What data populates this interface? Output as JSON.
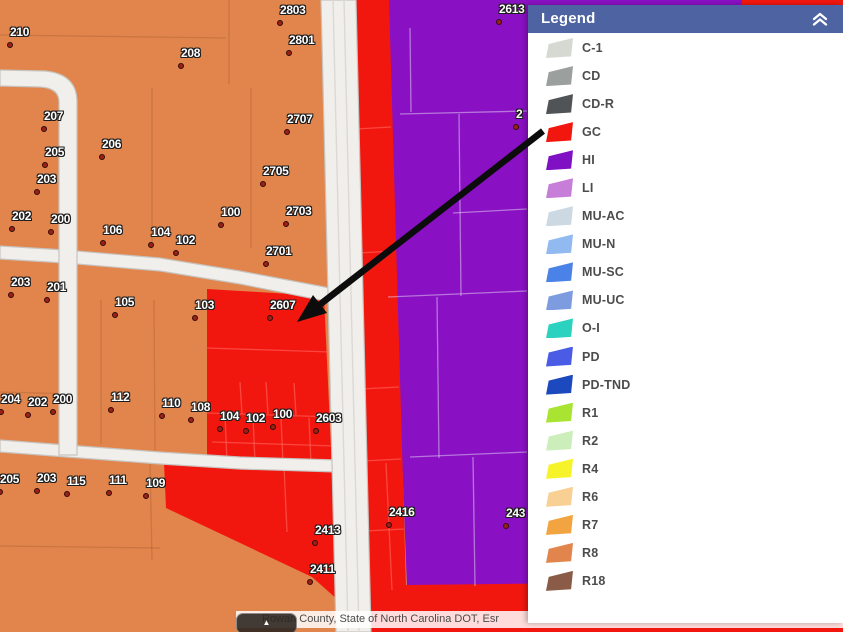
{
  "colors": {
    "R8_map": "#e1854d",
    "GC_map": "#f2170e",
    "HI_map": "#8a10c4",
    "header_bg": "#4e64a2",
    "arrow": "#0c0c0c"
  },
  "legend": {
    "title": "Legend",
    "items": [
      {
        "label": "C-1",
        "color": "#d6d9d2"
      },
      {
        "label": "CD",
        "color": "#9b9f9e"
      },
      {
        "label": "CD-R",
        "color": "#505456"
      },
      {
        "label": "GC",
        "color": "#f2170e"
      },
      {
        "label": "HI",
        "color": "#7f10c3"
      },
      {
        "label": "LI",
        "color": "#c77ed8"
      },
      {
        "label": "MU-AC",
        "color": "#ccd9e3"
      },
      {
        "label": "MU-N",
        "color": "#90baf0"
      },
      {
        "label": "MU-SC",
        "color": "#4b82e8"
      },
      {
        "label": "MU-UC",
        "color": "#7d9ce0"
      },
      {
        "label": "O-I",
        "color": "#2bd2c0"
      },
      {
        "label": "PD",
        "color": "#4a5ce6"
      },
      {
        "label": "PD-TND",
        "color": "#1c49bd"
      },
      {
        "label": "R1",
        "color": "#a8e431"
      },
      {
        "label": "R2",
        "color": "#cbeebb"
      },
      {
        "label": "R4",
        "color": "#f7f32b"
      },
      {
        "label": "R6",
        "color": "#f8d093"
      },
      {
        "label": "R7",
        "color": "#f2a440"
      },
      {
        "label": "R8",
        "color": "#e1854d"
      },
      {
        "label": "R18",
        "color": "#8a5b46"
      }
    ]
  },
  "map": {
    "labels": [
      {
        "t": "210",
        "x": 7,
        "y": 42
      },
      {
        "t": "208",
        "x": 178,
        "y": 63
      },
      {
        "t": "2803",
        "x": 277,
        "y": 20
      },
      {
        "t": "2801",
        "x": 286,
        "y": 50
      },
      {
        "t": "2707",
        "x": 284,
        "y": 129
      },
      {
        "t": "2705",
        "x": 260,
        "y": 181
      },
      {
        "t": "207",
        "x": 41,
        "y": 126
      },
      {
        "t": "206",
        "x": 99,
        "y": 154
      },
      {
        "t": "205",
        "x": 42,
        "y": 162
      },
      {
        "t": "203",
        "x": 34,
        "y": 189
      },
      {
        "t": "202",
        "x": 9,
        "y": 226
      },
      {
        "t": "200",
        "x": 48,
        "y": 229
      },
      {
        "t": "106",
        "x": 100,
        "y": 240
      },
      {
        "t": "104",
        "x": 148,
        "y": 242
      },
      {
        "t": "102",
        "x": 173,
        "y": 250
      },
      {
        "t": "100",
        "x": 218,
        "y": 222
      },
      {
        "t": "2703",
        "x": 283,
        "y": 221
      },
      {
        "t": "2701",
        "x": 263,
        "y": 261
      },
      {
        "t": "203",
        "x": 8,
        "y": 292
      },
      {
        "t": "201",
        "x": 44,
        "y": 297
      },
      {
        "t": "105",
        "x": 112,
        "y": 312
      },
      {
        "t": "103",
        "x": 192,
        "y": 315
      },
      {
        "t": "2607",
        "x": 267,
        "y": 315
      },
      {
        "t": "204",
        "x": -2,
        "y": 409
      },
      {
        "t": "202",
        "x": 25,
        "y": 412
      },
      {
        "t": "200",
        "x": 50,
        "y": 409
      },
      {
        "t": "112",
        "x": 108,
        "y": 407
      },
      {
        "t": "110",
        "x": 159,
        "y": 413
      },
      {
        "t": "108",
        "x": 188,
        "y": 417
      },
      {
        "t": "104",
        "x": 217,
        "y": 426
      },
      {
        "t": "102",
        "x": 243,
        "y": 428
      },
      {
        "t": "100",
        "x": 270,
        "y": 424
      },
      {
        "t": "2603",
        "x": 313,
        "y": 428
      },
      {
        "t": "205",
        "x": -3,
        "y": 489
      },
      {
        "t": "203",
        "x": 34,
        "y": 488
      },
      {
        "t": "115",
        "x": 64,
        "y": 491
      },
      {
        "t": "111",
        "x": 106,
        "y": 490
      },
      {
        "t": "109",
        "x": 143,
        "y": 493
      },
      {
        "t": "2413",
        "x": 312,
        "y": 540
      },
      {
        "t": "2411",
        "x": 307,
        "y": 579
      },
      {
        "t": "2416",
        "x": 386,
        "y": 522
      },
      {
        "t": "243",
        "x": 503,
        "y": 523
      },
      {
        "t": "2613",
        "x": 496,
        "y": 19
      },
      {
        "t": "2",
        "x": 513,
        "y": 124
      }
    ]
  },
  "attribution": {
    "text": "Rowan County, State of North Carolina DOT, Esr",
    "expand_icon": "▲"
  }
}
